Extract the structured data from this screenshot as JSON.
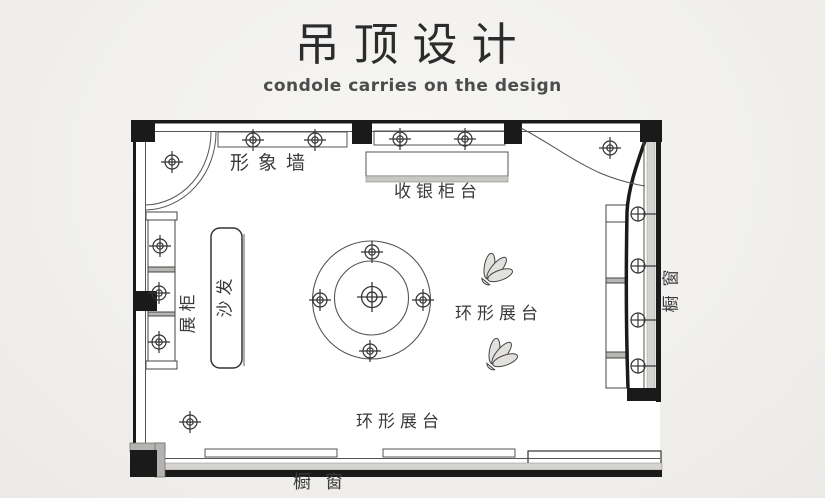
{
  "header": {
    "title": "吊顶设计",
    "subtitle": "condole carries on the design"
  },
  "plan": {
    "labels": {
      "image_wall": "形象墙",
      "cashier_counter": "收银柜台",
      "display_cabinet": "展柜",
      "sofa": "沙发",
      "ring_display_center": "环形展台",
      "ring_display_bottom": "环形展台",
      "shop_window_right": "橱窗",
      "shop_window_bottom": "橱窗"
    },
    "colors": {
      "wall_black": "#1a1a1a",
      "drawing_line": "#555555",
      "accent_gray": "#d6d4d1",
      "text": "#3a3a3a",
      "paper": "#f1f0ed"
    },
    "icons": {
      "ceiling_light": "ceiling-light-icon",
      "ceiling_light_center": "ceiling-light-center-icon",
      "window_light": "window-light-icon"
    },
    "lights": {
      "fancy": [
        [
          172,
          162
        ],
        [
          253,
          140
        ],
        [
          315,
          140
        ],
        [
          400,
          139
        ],
        [
          465,
          139
        ],
        [
          610,
          148
        ],
        [
          160,
          246
        ],
        [
          159,
          293
        ],
        [
          159,
          342
        ],
        [
          372,
          252
        ],
        [
          320,
          300
        ],
        [
          423,
          300
        ],
        [
          370,
          351
        ],
        [
          190,
          422
        ]
      ],
      "center_big": [
        [
          372,
          297
        ]
      ],
      "plain": [
        [
          638,
          214
        ],
        [
          638,
          266
        ],
        [
          638,
          320
        ],
        [
          638,
          366
        ]
      ]
    }
  }
}
